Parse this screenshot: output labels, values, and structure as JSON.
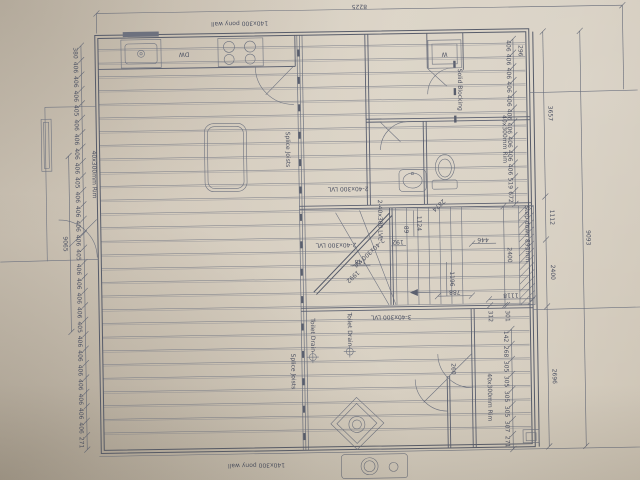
{
  "labels": {
    "pony_wall_top": "140x300 pony wall",
    "pony_wall_bottom": "140x300 pony wall",
    "dishwasher": "DW",
    "washer": "W",
    "solid_blocking": "Solid Blocking",
    "splice_joists_upper": "Splice Joists",
    "splice_joists_lower": "Splice Joists",
    "rim_left": "40x300mm Rim",
    "rim_right": "40x300mm Rim",
    "rim_lower_right": "40x300mm Rim",
    "lvl2_bath": "2-40x300 LVL",
    "lvl2_mid": "2-40x300 LVL",
    "lvl2_vert": "2-40x300 LVL",
    "lvl2_diag": "2-40x300 LVL",
    "lvl3": "3-40x300 LVL",
    "toilet_drain_left": "Toilet Drain",
    "toilet_drain_right": "Toilet Drain",
    "step_down": "Step down 893mm"
  },
  "dims": {
    "overall_top": "8225",
    "overall_left": "9065",
    "overall_right": "9093",
    "top_right_296": "296",
    "right_3657": "3657",
    "right_1112": "1112",
    "right_2400": "2400",
    "right_2696": "2696",
    "inner_2400": "2400",
    "stair_2874": "2874",
    "stair_1124": "1124",
    "stair_1196": "1196",
    "stair_788": "788",
    "stair_1118": "1118",
    "stair_446": "446",
    "dim_192": "192",
    "dim_148": "148",
    "dim_89": "89",
    "diag_1992": "1992",
    "dim_312": "312",
    "dim_301": "301",
    "dim_260": "260"
  },
  "chains": {
    "left": [
      "380",
      "406",
      "406",
      "406",
      "405",
      "406",
      "406",
      "406",
      "406",
      "405",
      "406",
      "406",
      "406",
      "406",
      "405",
      "406",
      "406",
      "406",
      "406",
      "405",
      "406",
      "406",
      "406",
      "406",
      "406",
      "406",
      "406",
      "271"
    ],
    "right": [
      "406",
      "406",
      "406",
      "406",
      "406",
      "406",
      "406",
      "406",
      "406",
      "406",
      "519",
      "672"
    ],
    "corner": [
      "142",
      "268",
      "305",
      "305",
      "305",
      "305",
      "307",
      "271"
    ]
  }
}
